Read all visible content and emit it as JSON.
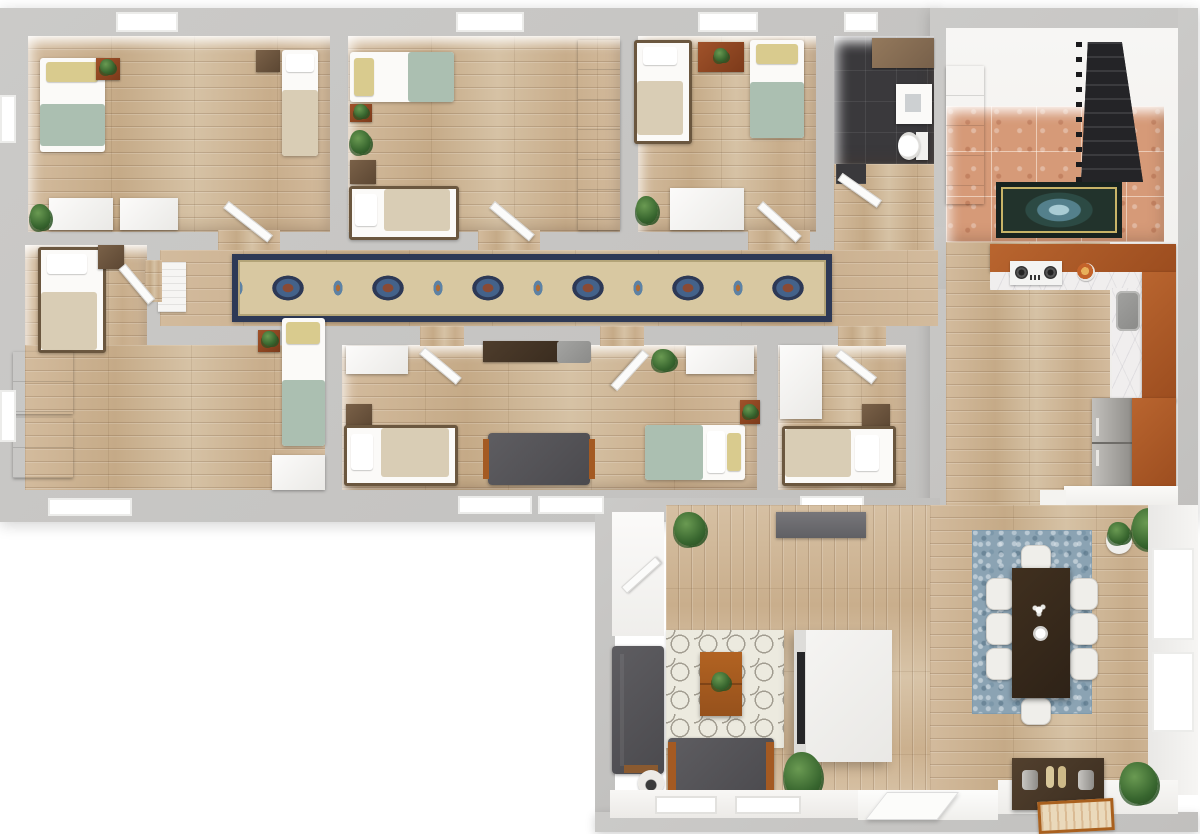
{
  "scene": {
    "type": "3d-floor-plan-render",
    "view": "top-down",
    "description": "Top-down 3D rendering of a furnished multi-bedroom apartment with hallway runner rug, bathroom, tiled entry with staircase, L-shaped kitchen, and open living-dining area",
    "rooms": [
      {
        "name": "bedroom-top-left",
        "furniture": [
          "twin-bed-sage",
          "twin-bed-beige",
          "plant-stand",
          "nightstand",
          "dresser",
          "dresser",
          "floor-plant",
          "door"
        ]
      },
      {
        "name": "bedroom-top-middle",
        "furniture": [
          "twin-bed-sage",
          "twin-bed-beige",
          "plant-stand",
          "floor-plant",
          "nightstand",
          "wardrobe",
          "door"
        ]
      },
      {
        "name": "bedroom-top-right",
        "furniture": [
          "twin-bed-beige",
          "twin-bed-sage",
          "wood-dresser",
          "white-dresser",
          "floor-plant",
          "door"
        ]
      },
      {
        "name": "bathroom",
        "furniture": [
          "wood-vanity",
          "sink",
          "toilet",
          "door"
        ]
      },
      {
        "name": "entry-foyer",
        "furniture": [
          "staircase",
          "accent-rug",
          "white-cabinet"
        ]
      },
      {
        "name": "kitchen",
        "furniture": [
          "l-shaped-counter",
          "gas-cooktop",
          "kitchen-sink",
          "refrigerator",
          "food-plate",
          "white-counter"
        ]
      },
      {
        "name": "hallway",
        "furniture": [
          "runner-rug",
          "radiator"
        ]
      },
      {
        "name": "bedroom-mid-left",
        "furniture": [
          "twin-bed-beige",
          "twin-bed-sage",
          "nightstand",
          "dresser",
          "dresser",
          "dresser",
          "plant-stand",
          "door"
        ]
      },
      {
        "name": "bedroom-mid-center",
        "furniture": [
          "closet",
          "closet",
          "desk",
          "desk-chair",
          "twin-bed-beige",
          "twin-bed-sage",
          "sofa",
          "nightstand",
          "plant-stand",
          "floor-plant",
          "door",
          "door"
        ]
      },
      {
        "name": "bedroom-mid-right",
        "furniture": [
          "closet",
          "twin-bed-beige",
          "nightstand",
          "door"
        ]
      },
      {
        "name": "closet-room",
        "furniture": [
          "door"
        ]
      },
      {
        "name": "living-room",
        "furniture": [
          "sofa-vertical",
          "loveseat",
          "coffee-table",
          "trellis-rug",
          "tv-cabinet",
          "media-console",
          "stool",
          "floor-plant",
          "floor-plant",
          "entry-door",
          "windows"
        ]
      },
      {
        "name": "dining-room",
        "furniture": [
          "dining-table",
          "chair-x8",
          "blue-area-rug",
          "console-table",
          "decor-vases",
          "picture-frame",
          "shrub",
          "potted-plants",
          "windows"
        ]
      }
    ],
    "bed_count": 9,
    "floor_finishes": [
      "light-oak-plank",
      "terracotta-tile",
      "charcoal-tile",
      "white"
    ]
  },
  "palette": {
    "bg": "#ffffff",
    "wall": "#c8c7c5",
    "white-face": "#f4f3f1",
    "wood": "#ccb190",
    "tile": "#d69a78",
    "tile-dark": "#3a393c",
    "stairs": "#29292b",
    "cabinet-rust": "#ad5a28",
    "marble": "#f0eeee",
    "sofa-gray": "#57565a",
    "sage": "#abbfb1",
    "beige-bed": "#d9cdb5",
    "pillow-yellow": "#d9cb8e",
    "frame": "#6b573f",
    "nightstand-brown": "#6a523c",
    "stand-rust": "#8e4423",
    "white-furn": "#f8f7f5",
    "plant-green": "#3f6c33",
    "rug-navy": "#2d3956",
    "rug-cream": "#d8c8a1",
    "rug-blue": "#8ba3b3",
    "rug-trellis": "#eceadf",
    "table-dark": "#38291d",
    "console-brown": "#483828",
    "steel": "#a9a7a3",
    "coffee-wood": "#a85a20",
    "door-white": "#fbfbfa"
  }
}
